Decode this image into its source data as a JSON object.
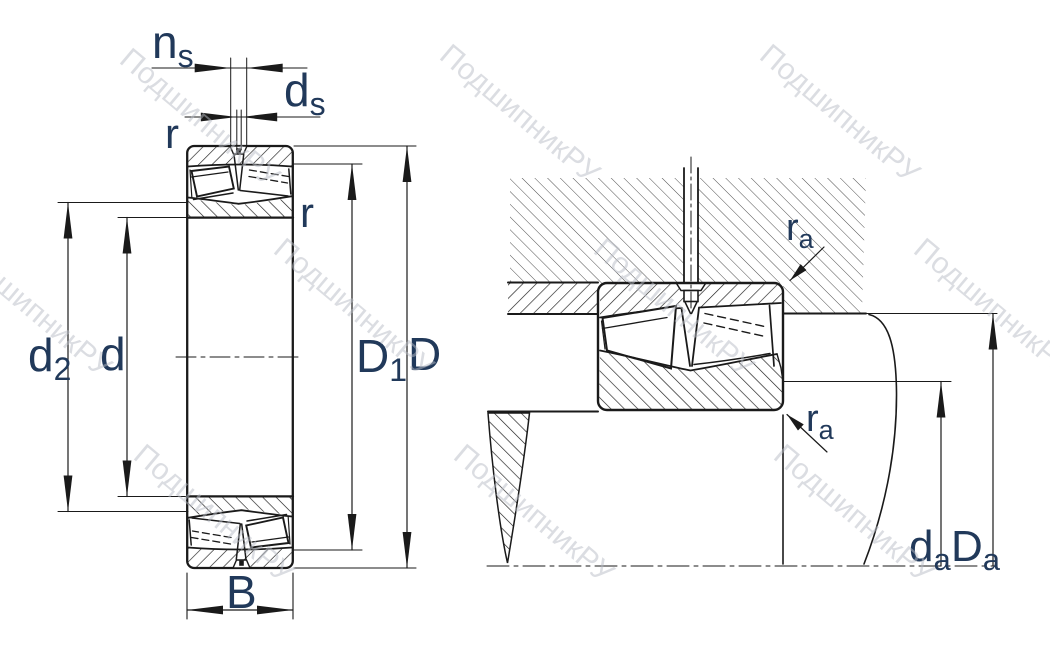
{
  "drawing": {
    "type": "bearing-technical-drawing",
    "views": {
      "left": "bearing cross-section with dimensions",
      "right": "bearing mounted in housing on shaft"
    }
  },
  "labels": {
    "ns": {
      "main": "n",
      "sub": "s"
    },
    "ds": {
      "main": "d",
      "sub": "s"
    },
    "r_top": "r",
    "r_inner": "r",
    "d2": {
      "main": "d",
      "sub": "2"
    },
    "d": "d",
    "D1": {
      "main": "D",
      "sub": "1"
    },
    "D": "D",
    "B": "B",
    "ra_top": {
      "main": "r",
      "sub": "a"
    },
    "ra_bottom": {
      "main": "r",
      "sub": "a"
    },
    "da": {
      "main": "d",
      "sub": "a"
    },
    "Da": {
      "main": "D",
      "sub": "a"
    }
  },
  "watermark": {
    "text": "ПодшипникРУ",
    "color": "#b9bdc6"
  },
  "colors": {
    "line": "#1a1a1a",
    "housing_hatch": "#3c3c3c",
    "label": "#21395a",
    "background": "#ffffff"
  }
}
